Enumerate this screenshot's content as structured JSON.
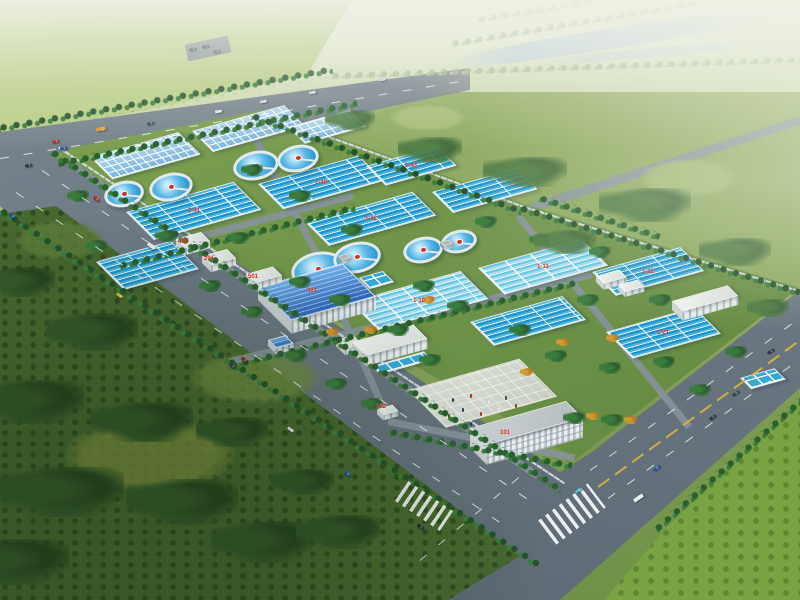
{
  "scene": {
    "subject": "Aerial bird's-eye architectural rendering of a water treatment plant campus",
    "elements": "rectangular process basins, circular clarifier tanks, blue-roof workshop, white utility buildings, administration building, entry plaza, tree-lined roads, surrounding fields and river"
  },
  "labels": {
    "b101": "101",
    "b102": "102",
    "b201": "201",
    "b301": "301",
    "b401": "401",
    "b501": "501",
    "tanks": [
      "1-40",
      "1-41",
      "1-42",
      "1-43",
      "1-10",
      "1-11",
      "1-12",
      "1-21"
    ]
  },
  "colors": {
    "water_vivid": "#1d92cb",
    "water_light": "#a6def1",
    "clarifier_water": "#2f9fd8",
    "roof_blue": "#2e6cc0",
    "building_white": "#f4f6f3",
    "label_red": "#e02515",
    "road_gray": "#6b7680",
    "tree_green": "#2c6330",
    "field_green": "#8aa65e",
    "river_blue": "#b6c9e0",
    "haze": "#edf0e1"
  }
}
